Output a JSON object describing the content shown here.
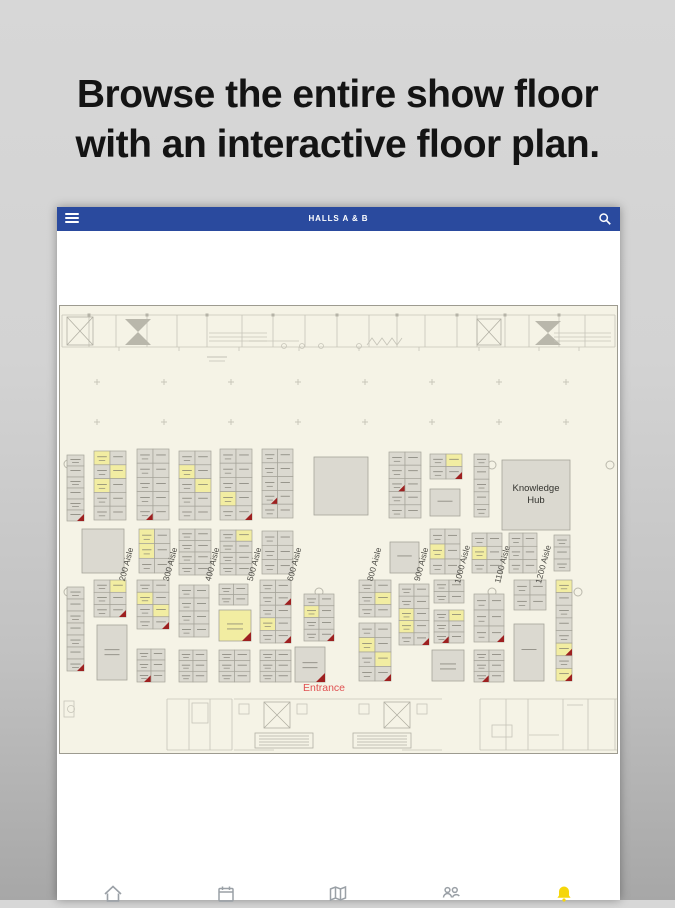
{
  "headline": {
    "line1": "Browse the entire show floor",
    "line2": "with an interactive floor plan."
  },
  "app": {
    "header": {
      "title": "HALLS A & B",
      "bg_color": "#2a4a9e",
      "menu_icon": "hamburger-icon",
      "search_icon": "search-icon"
    },
    "nav_icons": [
      {
        "name": "home-icon",
        "color": "#9aa0a6"
      },
      {
        "name": "calendar-icon",
        "color": "#9aa0a6"
      },
      {
        "name": "map-icon",
        "color": "#9aa0a6"
      },
      {
        "name": "people-icon",
        "color": "#9aa0a6"
      },
      {
        "name": "alerts-bell-icon",
        "color": "#f5d60a"
      }
    ]
  },
  "floorplan": {
    "bg": "#f5f3e6",
    "border_color": "#9d9b90",
    "wall_color": "#c6c4b8",
    "wall_dark": "#b2b0a4",
    "booth_fill": "#dbd9d0",
    "booth_yellow": "#f2eda2",
    "booth_stroke": "#a5a399",
    "text_line_color": "#7a786e",
    "red_color": "#9e2020",
    "marker_color": "#c9c7ba",
    "entrance": {
      "label": "Entrance",
      "color": "#e05050",
      "x": 265,
      "y": 386
    },
    "aisle_y": 260,
    "aisle_color": "#4d4c46",
    "aisles": [
      {
        "label": "200 Aisle",
        "x": 70
      },
      {
        "label": "300 Aisle",
        "x": 114
      },
      {
        "label": "400 Aisle",
        "x": 156
      },
      {
        "label": "500 Aisle",
        "x": 198
      },
      {
        "label": "600 Aisle",
        "x": 238
      },
      {
        "label": "800 Aisle",
        "x": 318
      },
      {
        "label": "900 Aisle",
        "x": 365
      },
      {
        "label": "1000 Aisle",
        "x": 406
      },
      {
        "label": "1100 Aisle",
        "x": 446
      },
      {
        "label": "1200 Aisle",
        "x": 487
      }
    ],
    "specials": [
      {
        "name": "booth-knowledge-hub",
        "label": "Knowledge Hub",
        "x": 443,
        "y": 155,
        "w": 68,
        "h": 70,
        "lines": 0
      },
      {
        "name": "booth-large-a",
        "x": 255,
        "y": 152,
        "w": 54,
        "h": 58,
        "lines": 0
      },
      {
        "name": "booth-mid-left",
        "x": 23,
        "y": 224,
        "w": 42,
        "h": 44,
        "lines": 0
      },
      {
        "name": "booth-single-1",
        "x": 371,
        "y": 184,
        "w": 30,
        "h": 27,
        "lines": 1
      },
      {
        "name": "booth-pavilion",
        "x": 38,
        "y": 320,
        "w": 30,
        "h": 55,
        "lines": 2
      },
      {
        "name": "booth-lounge",
        "x": 160,
        "y": 305,
        "w": 32,
        "h": 31,
        "fill": "#f2eda2",
        "red": true,
        "lines": 2
      },
      {
        "name": "booth-single-2",
        "x": 331,
        "y": 237,
        "w": 29,
        "h": 31,
        "lines": 1
      },
      {
        "name": "booth-corner",
        "x": 236,
        "y": 342,
        "w": 30,
        "h": 35,
        "red": true,
        "lines": 2
      },
      {
        "name": "booth-lab",
        "x": 373,
        "y": 345,
        "w": 32,
        "h": 31,
        "lines": 2
      },
      {
        "name": "booth-tall",
        "x": 455,
        "y": 319,
        "w": 30,
        "h": 57,
        "lines": 1
      }
    ],
    "clusters": [
      {
        "x": 8,
        "y": 150,
        "cols": 1,
        "rows": 6,
        "w": 17,
        "h": 66,
        "red": [
          5
        ]
      },
      {
        "x": 35,
        "y": 146,
        "cols": 2,
        "rows": 5,
        "w": 32,
        "h": 69,
        "yellow": [
          0,
          3,
          4
        ]
      },
      {
        "x": 78,
        "y": 144,
        "cols": 2,
        "rows": 5,
        "w": 32,
        "h": 71,
        "red": [
          8
        ]
      },
      {
        "x": 120,
        "y": 146,
        "cols": 2,
        "rows": 5,
        "w": 32,
        "h": 69,
        "yellow": [
          2,
          5
        ]
      },
      {
        "x": 161,
        "y": 144,
        "cols": 2,
        "rows": 5,
        "w": 32,
        "h": 71,
        "yellow": [
          6
        ],
        "red": [
          9
        ]
      },
      {
        "x": 203,
        "y": 144,
        "cols": 2,
        "rows": 5,
        "w": 31,
        "h": 69,
        "red": [
          6
        ]
      },
      {
        "x": 330,
        "y": 147,
        "cols": 2,
        "rows": 5,
        "w": 32,
        "h": 66,
        "red": [
          4
        ]
      },
      {
        "x": 371,
        "y": 149,
        "cols": 2,
        "rows": 2,
        "w": 32,
        "h": 25,
        "yellow": [
          1
        ],
        "red": [
          3
        ]
      },
      {
        "x": 415,
        "y": 149,
        "cols": 1,
        "rows": 5,
        "w": 15,
        "h": 63
      },
      {
        "x": 80,
        "y": 224,
        "cols": 2,
        "rows": 3,
        "w": 31,
        "h": 44,
        "yellow": [
          0,
          2
        ]
      },
      {
        "x": 120,
        "y": 224,
        "cols": 2,
        "rows": 4,
        "w": 32,
        "h": 46
      },
      {
        "x": 161,
        "y": 225,
        "cols": 2,
        "rows": 4,
        "w": 32,
        "h": 45,
        "yellow": [
          1
        ]
      },
      {
        "x": 203,
        "y": 226,
        "cols": 2,
        "rows": 3,
        "w": 31,
        "h": 43
      },
      {
        "x": 371,
        "y": 224,
        "cols": 2,
        "rows": 3,
        "w": 30,
        "h": 45,
        "yellow": [
          2
        ]
      },
      {
        "x": 413,
        "y": 228,
        "cols": 2,
        "rows": 3,
        "w": 30,
        "h": 40,
        "yellow": [
          2
        ]
      },
      {
        "x": 450,
        "y": 228,
        "cols": 2,
        "rows": 3,
        "w": 28,
        "h": 40
      },
      {
        "x": 495,
        "y": 230,
        "cols": 1,
        "rows": 3,
        "w": 16,
        "h": 36
      },
      {
        "x": 8,
        "y": 282,
        "cols": 1,
        "rows": 7,
        "w": 17,
        "h": 84,
        "red": [
          6
        ]
      },
      {
        "x": 35,
        "y": 275,
        "cols": 2,
        "rows": 3,
        "w": 32,
        "h": 37,
        "yellow": [
          1
        ],
        "red": [
          5
        ]
      },
      {
        "x": 78,
        "y": 275,
        "cols": 2,
        "rows": 4,
        "w": 32,
        "h": 49,
        "yellow": [
          2,
          5
        ],
        "red": [
          7
        ]
      },
      {
        "x": 78,
        "y": 344,
        "cols": 2,
        "rows": 3,
        "w": 28,
        "h": 33,
        "red": [
          4
        ]
      },
      {
        "x": 120,
        "y": 280,
        "cols": 2,
        "rows": 4,
        "w": 30,
        "h": 52
      },
      {
        "x": 120,
        "y": 345,
        "cols": 2,
        "rows": 3,
        "w": 28,
        "h": 32
      },
      {
        "x": 160,
        "y": 279,
        "cols": 2,
        "rows": 2,
        "w": 29,
        "h": 21
      },
      {
        "x": 160,
        "y": 345,
        "cols": 2,
        "rows": 3,
        "w": 31,
        "h": 32
      },
      {
        "x": 201,
        "y": 275,
        "cols": 2,
        "rows": 5,
        "w": 31,
        "h": 63,
        "yellow": [
          6
        ],
        "red": [
          3,
          9
        ]
      },
      {
        "x": 201,
        "y": 345,
        "cols": 2,
        "rows": 3,
        "w": 31,
        "h": 32
      },
      {
        "x": 245,
        "y": 289,
        "cols": 2,
        "rows": 4,
        "w": 30,
        "h": 47,
        "yellow": [
          2
        ],
        "red": [
          7
        ]
      },
      {
        "x": 300,
        "y": 275,
        "cols": 2,
        "rows": 3,
        "w": 32,
        "h": 37,
        "yellow": [
          3
        ]
      },
      {
        "x": 300,
        "y": 318,
        "cols": 2,
        "rows": 4,
        "w": 32,
        "h": 58,
        "yellow": [
          2,
          5
        ],
        "red": [
          7
        ]
      },
      {
        "x": 340,
        "y": 279,
        "cols": 2,
        "rows": 5,
        "w": 30,
        "h": 61,
        "yellow": [
          4,
          6
        ],
        "red": [
          9
        ]
      },
      {
        "x": 375,
        "y": 275,
        "cols": 2,
        "rows": 2,
        "w": 30,
        "h": 23
      },
      {
        "x": 375,
        "y": 305,
        "cols": 2,
        "rows": 3,
        "w": 30,
        "h": 33,
        "yellow": [
          1
        ],
        "red": [
          4
        ]
      },
      {
        "x": 415,
        "y": 289,
        "cols": 2,
        "rows": 3,
        "w": 30,
        "h": 48,
        "red": [
          5
        ]
      },
      {
        "x": 415,
        "y": 345,
        "cols": 2,
        "rows": 3,
        "w": 30,
        "h": 32,
        "red": [
          4
        ]
      },
      {
        "x": 455,
        "y": 275,
        "cols": 2,
        "rows": 2,
        "w": 32,
        "h": 30
      },
      {
        "x": 497,
        "y": 275,
        "cols": 1,
        "rows": 8,
        "w": 16,
        "h": 101,
        "yellow": [
          0,
          5,
          7
        ],
        "red": [
          5,
          7
        ]
      }
    ],
    "door_markers": [
      [
        9,
        159
      ],
      [
        133,
        159
      ],
      [
        260,
        160
      ],
      [
        346,
        160
      ],
      [
        433,
        160
      ],
      [
        551,
        160
      ],
      [
        9,
        287
      ],
      [
        133,
        287
      ],
      [
        260,
        287
      ],
      [
        346,
        287
      ],
      [
        433,
        287
      ],
      [
        519,
        287
      ]
    ]
  }
}
